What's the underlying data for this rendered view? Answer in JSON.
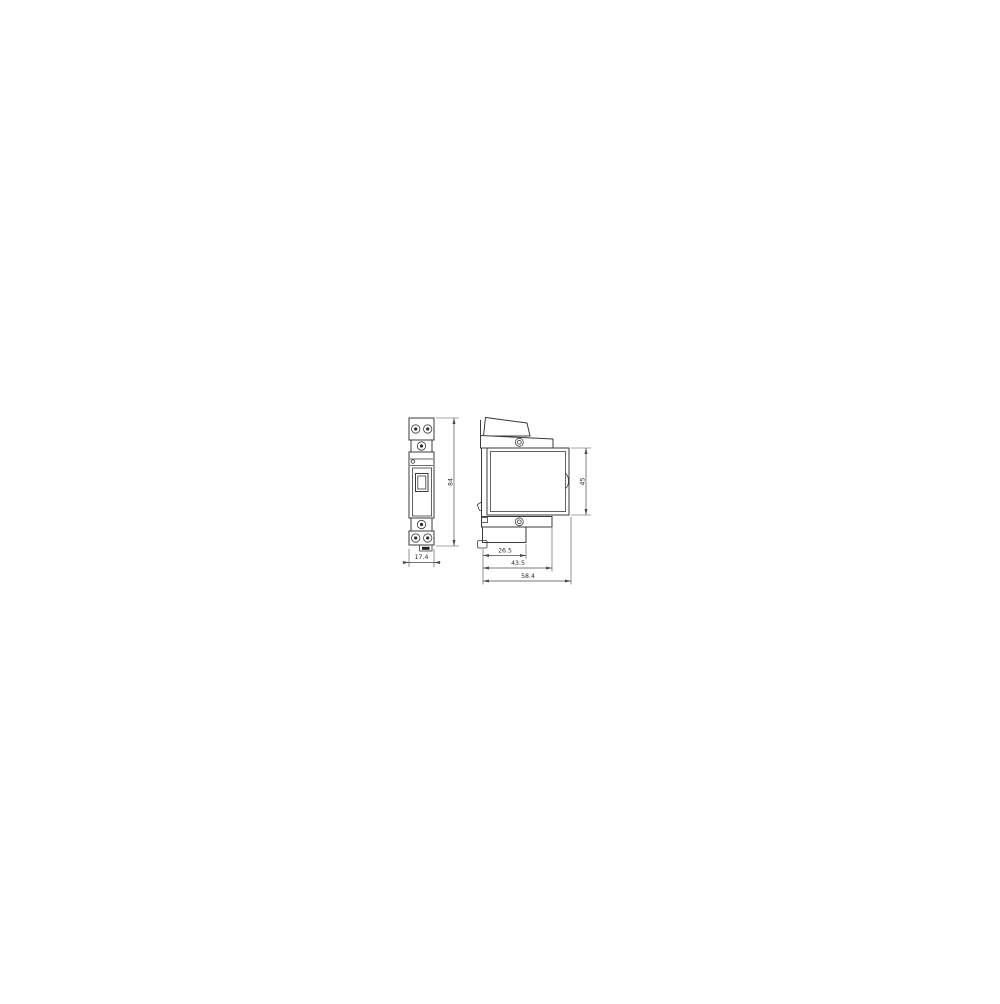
{
  "drawing": {
    "kind": "technical-dimension-drawing",
    "subject": "DIN-rail modular switch device, front and side views",
    "background_color": "#ffffff",
    "line_color": "#3b3b3b",
    "dims": {
      "front_width": {
        "value": "17.4",
        "orientation": "horizontal",
        "view": "front"
      },
      "front_height": {
        "value": "84",
        "orientation": "vertical",
        "view": "front"
      },
      "side_body_height": {
        "value": "45",
        "orientation": "vertical",
        "view": "side"
      },
      "depth_step": {
        "value": "26.5",
        "orientation": "horizontal",
        "view": "side"
      },
      "depth_terminal": {
        "value": "43.5",
        "orientation": "horizontal",
        "view": "side"
      },
      "depth_overall": {
        "value": "58.4",
        "orientation": "horizontal",
        "view": "side"
      }
    }
  }
}
